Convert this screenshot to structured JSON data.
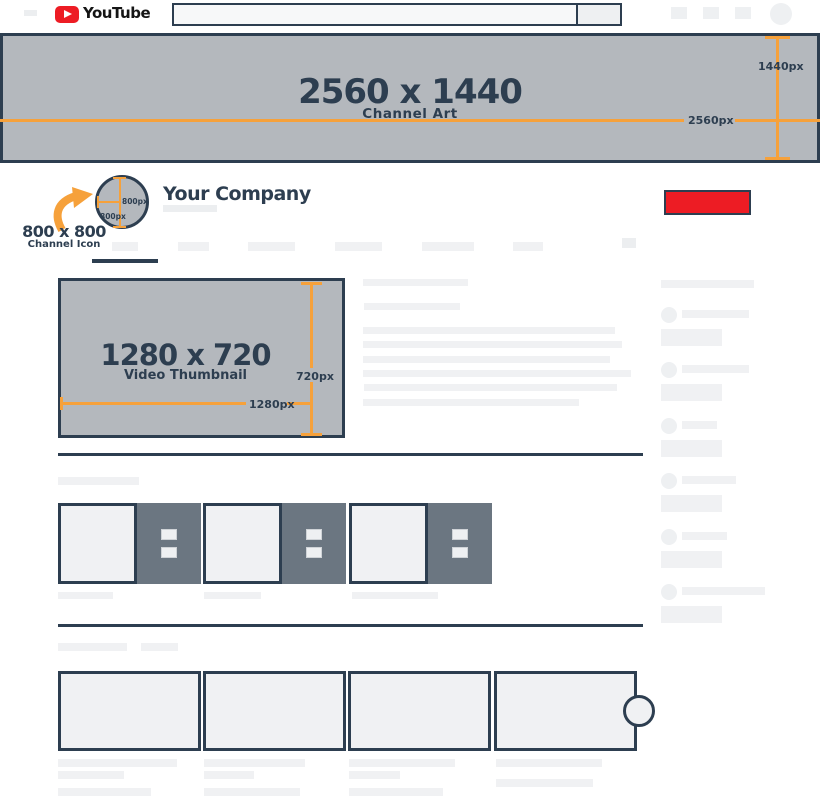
{
  "brand": {
    "name": "YouTube"
  },
  "banner": {
    "title": "2560 x 1440",
    "subtitle": "Channel Art",
    "width_label": "2560px",
    "height_label": "1440px"
  },
  "channel": {
    "name": "Your Company",
    "icon_title": "800 x 800",
    "icon_subtitle": "Channel Icon",
    "icon_width_label": "800px",
    "icon_height_label": "800px"
  },
  "thumbnail": {
    "title": "1280 x 720",
    "subtitle": "Video Thumbnail",
    "width_label": "1280px",
    "height_label": "720px"
  },
  "icons": {
    "menu": "menu-placeholder",
    "play": "youtube-play-icon",
    "search": "search-button",
    "avatar": "avatar-circle",
    "more": "more-options-squares",
    "arrow": "curved-arrow-icon"
  },
  "colors": {
    "navy": "#2d3e50",
    "orange": "#f6a13b",
    "red": "#ed1c24",
    "banner_gray": "#b4b8bd",
    "slate": "#6b7681",
    "placeholder": "#f0f1f3",
    "placeholder_dark": "#eceef0",
    "white_chip": "#eef0f2"
  }
}
